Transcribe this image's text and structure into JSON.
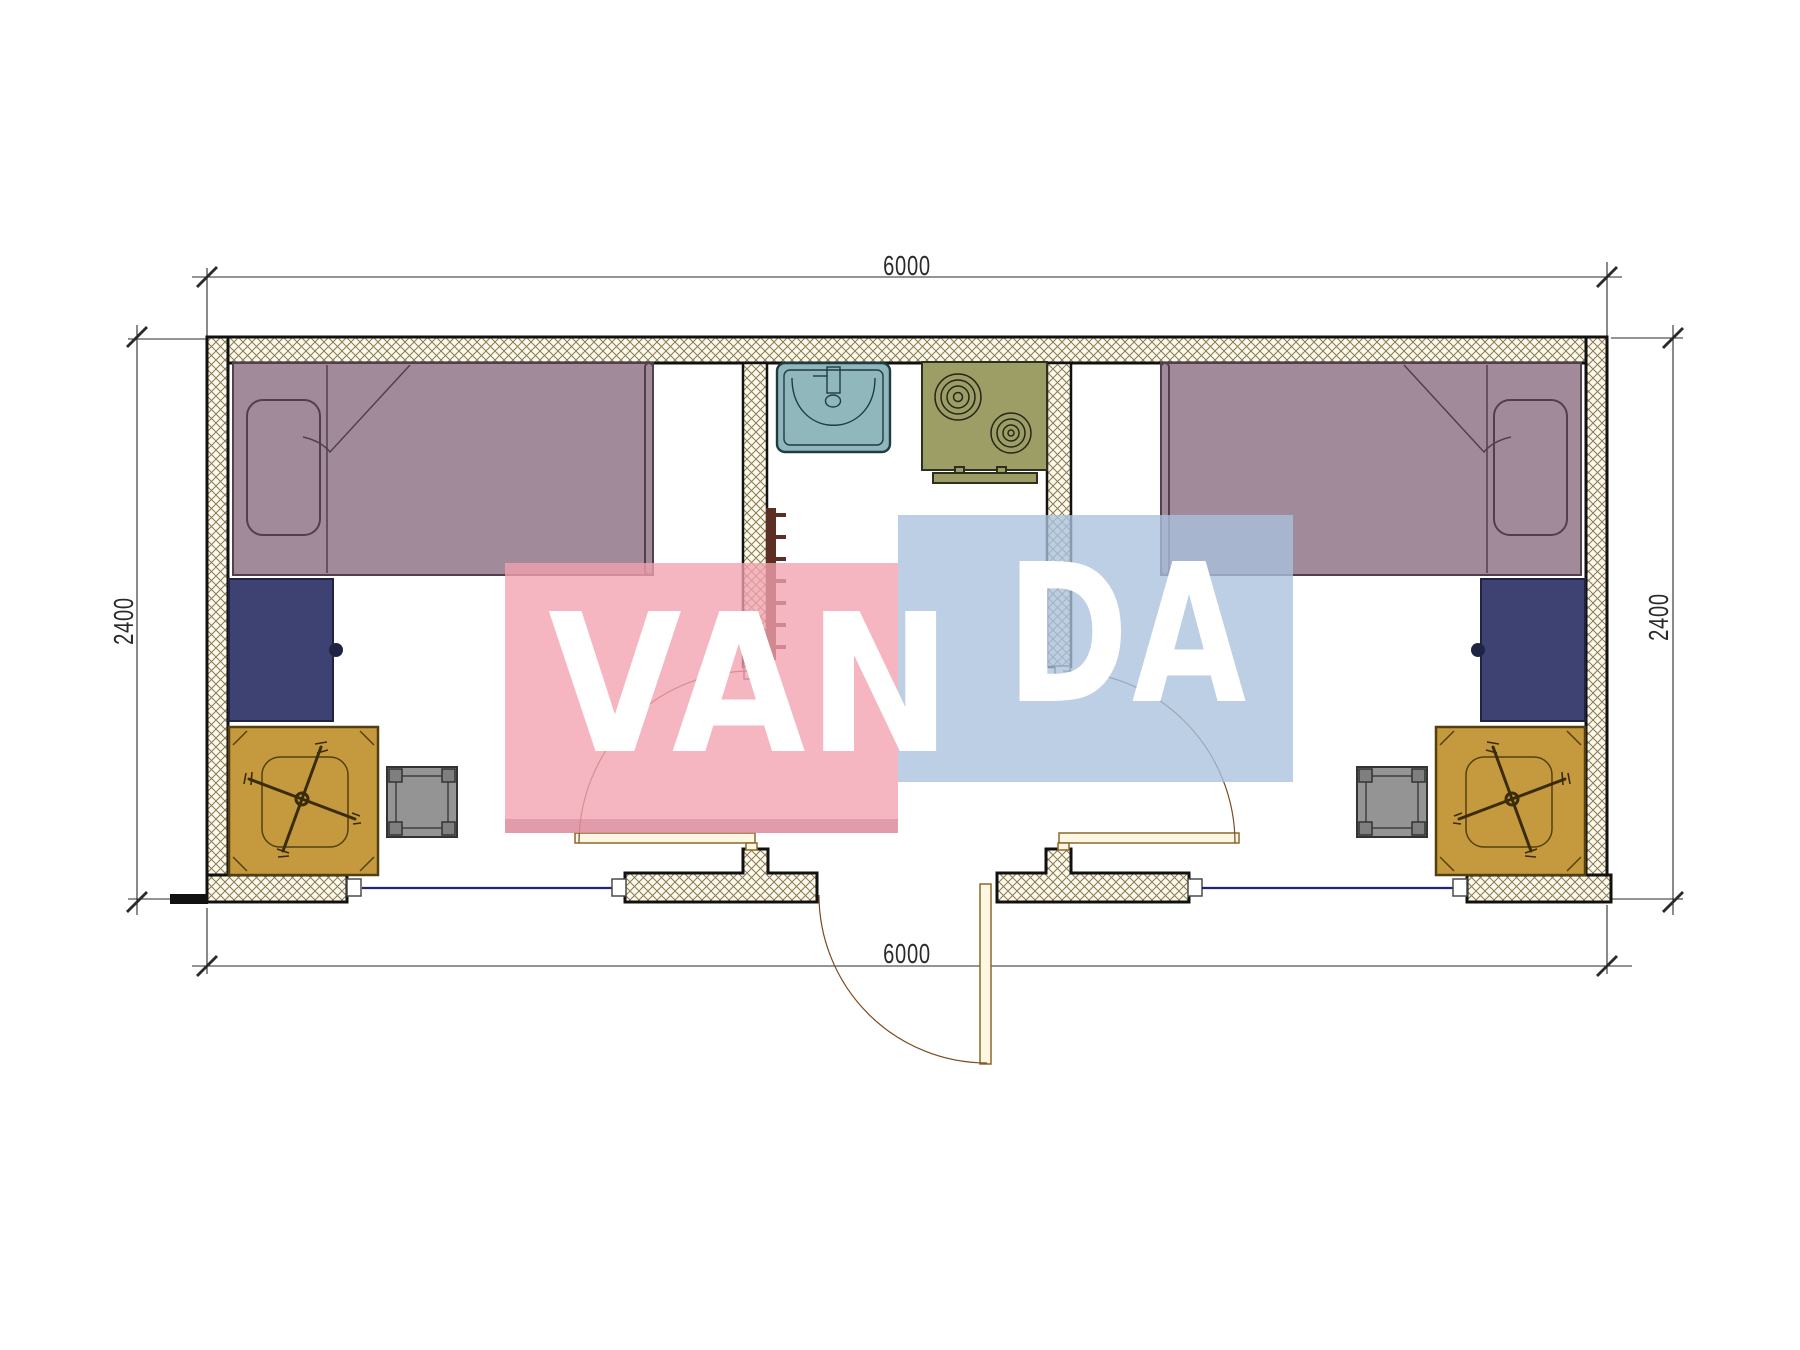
{
  "drawing": {
    "type": "floor-plan",
    "watermark_brand": "VANDA"
  },
  "dimensions": {
    "top": "6000",
    "bottom": "6000",
    "left": "2400",
    "right": "2400"
  },
  "watermark": {
    "left_text": "VAN",
    "right_text": "DA"
  },
  "icons": {
    "bed": "bed-top-view",
    "pillow": "pillow",
    "desk": "cabinet-desk",
    "chair": "office-chair-cross-base",
    "stool": "square-stool",
    "sink": "bathroom-sink",
    "stove": "two-burner-stove",
    "towel_rail": "towel-radiator",
    "door": "door-swing-arc",
    "window": "window-line"
  },
  "colors": {
    "wall_line": "#111111",
    "hatch_stroke": "#8a7a4e",
    "hatch_bg": "#fcf9ee",
    "bed": "#a18b9a",
    "bed_line": "#51404c",
    "desk": "#3d4272",
    "desk_line": "#1f2443",
    "chair": "#c59a3f",
    "chair_line": "#54400e",
    "stool": "#949494",
    "stool_line": "#333333",
    "sink": "#8fb7bc",
    "sink_line": "#1e3c42",
    "stove": "#9d9d66",
    "stove_line": "#2f2f20",
    "towel": "#5d2f24",
    "door_fill": "#fdf6e2",
    "door_line": "#8a6a2a",
    "arc": "#7a4a22",
    "window": "#23237e",
    "dim": "#2a2a2a",
    "wm_pink": "#f2a2b0",
    "wm_blue": "#a9c1de",
    "wm_text": "#ffffff"
  }
}
